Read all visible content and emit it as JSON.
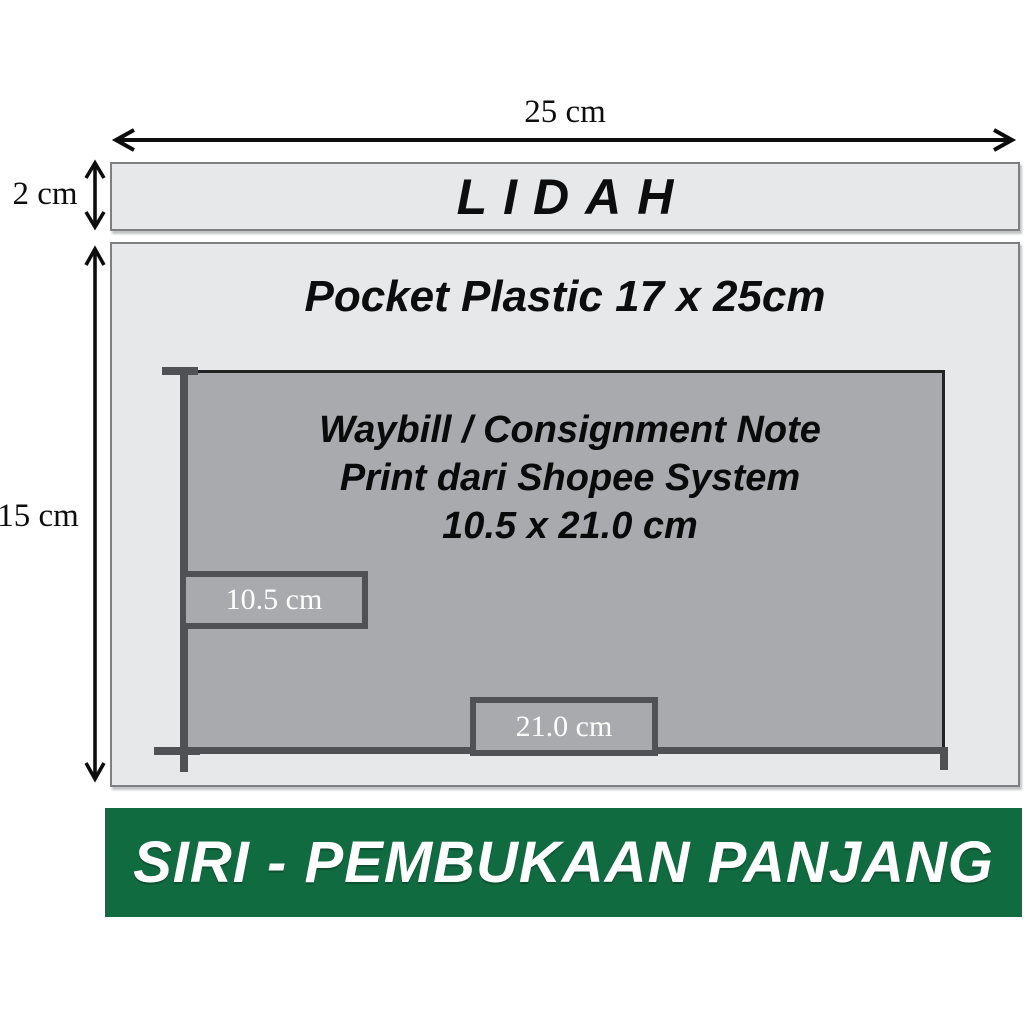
{
  "diagram": {
    "top_width_label": "25 cm",
    "flap": {
      "height_label": "2 cm",
      "label": "LIDAH"
    },
    "pocket": {
      "height_label": "15 cm",
      "title": "Pocket Plastic 17 x 25cm",
      "waybill": {
        "line1": "Waybill / Consignment Note",
        "line2": "Print dari Shopee System",
        "line3": "10.5 x 21.0 cm",
        "width_label": "10.5 cm",
        "length_label": "21.0 cm"
      }
    },
    "banner": {
      "text": "SIRI - PEMBUKAAN PANJANG"
    }
  },
  "colors": {
    "light_gray": "#e7e8ea",
    "mid_gray": "#a9aaad",
    "dim_gray": "#4f5154",
    "border_gray": "#7d7f82",
    "green": "#116b41",
    "ink": "#0d0d0d",
    "white": "#ffffff"
  }
}
